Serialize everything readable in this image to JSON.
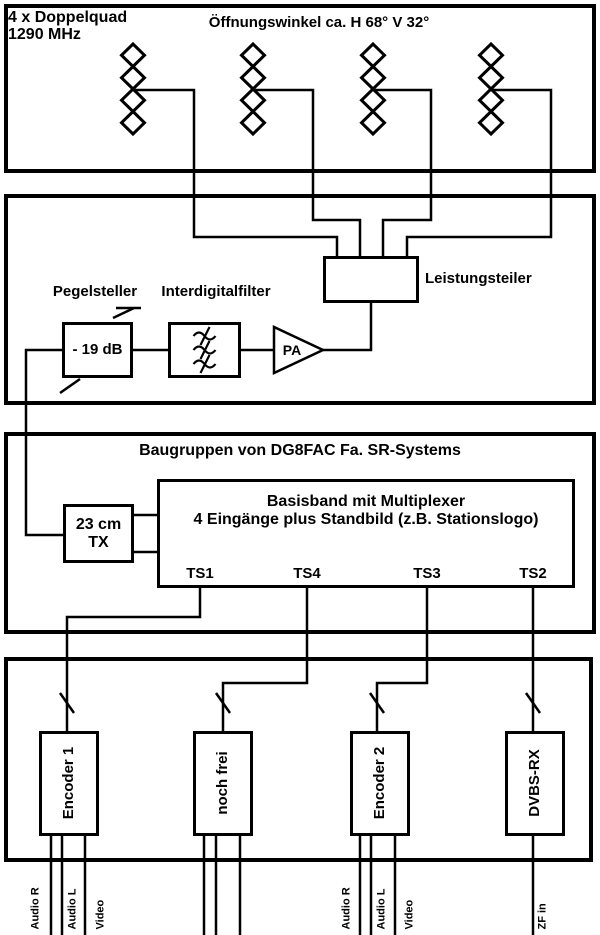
{
  "antenna_section": {
    "name_line1": "4 x Doppelquad",
    "name_line2": "1290 MHz",
    "beamwidth_note": "Öffnungswinkel ca. H 68° V 32°"
  },
  "rf_section": {
    "attenuator_label": "Pegelsteller",
    "attenuator_value": "- 19 dB",
    "filter_label": "Interdigitalfilter",
    "amplifier_label": "PA",
    "power_divider_label": "Leistungsteiler"
  },
  "baseband_section": {
    "title": "Baugruppen von DG8FAC Fa. SR-Systems",
    "tx_label_line1": "23 cm",
    "tx_label_line2": "TX",
    "multiplexer_line1": "Basisband mit Multiplexer",
    "multiplexer_line2": "4 Eingänge plus Standbild (z.B. Stationslogo)",
    "ports": [
      "TS1",
      "TS4",
      "TS3",
      "TS2"
    ]
  },
  "source_section": {
    "modules": [
      "Encoder 1",
      "noch frei",
      "Encoder 2",
      "DVBS-RX"
    ],
    "encoder1_inputs": [
      "Audio R",
      "Audio L",
      "Video"
    ],
    "encoder2_inputs": [
      "Audio R",
      "Audio L",
      "Video"
    ],
    "dvbs_input_label": "ZF in"
  },
  "icons": {
    "antenna_array": "doppelquad-diamond-stack",
    "filter_symbol": "bandpass-squiggle",
    "amplifier_symbol": "triangle-right",
    "bus_marker": "diagonal-slash",
    "adjustable_marker": "diagonal-arrow-with-bar"
  },
  "colors": {
    "line": "#000000",
    "background": "#ffffff"
  }
}
